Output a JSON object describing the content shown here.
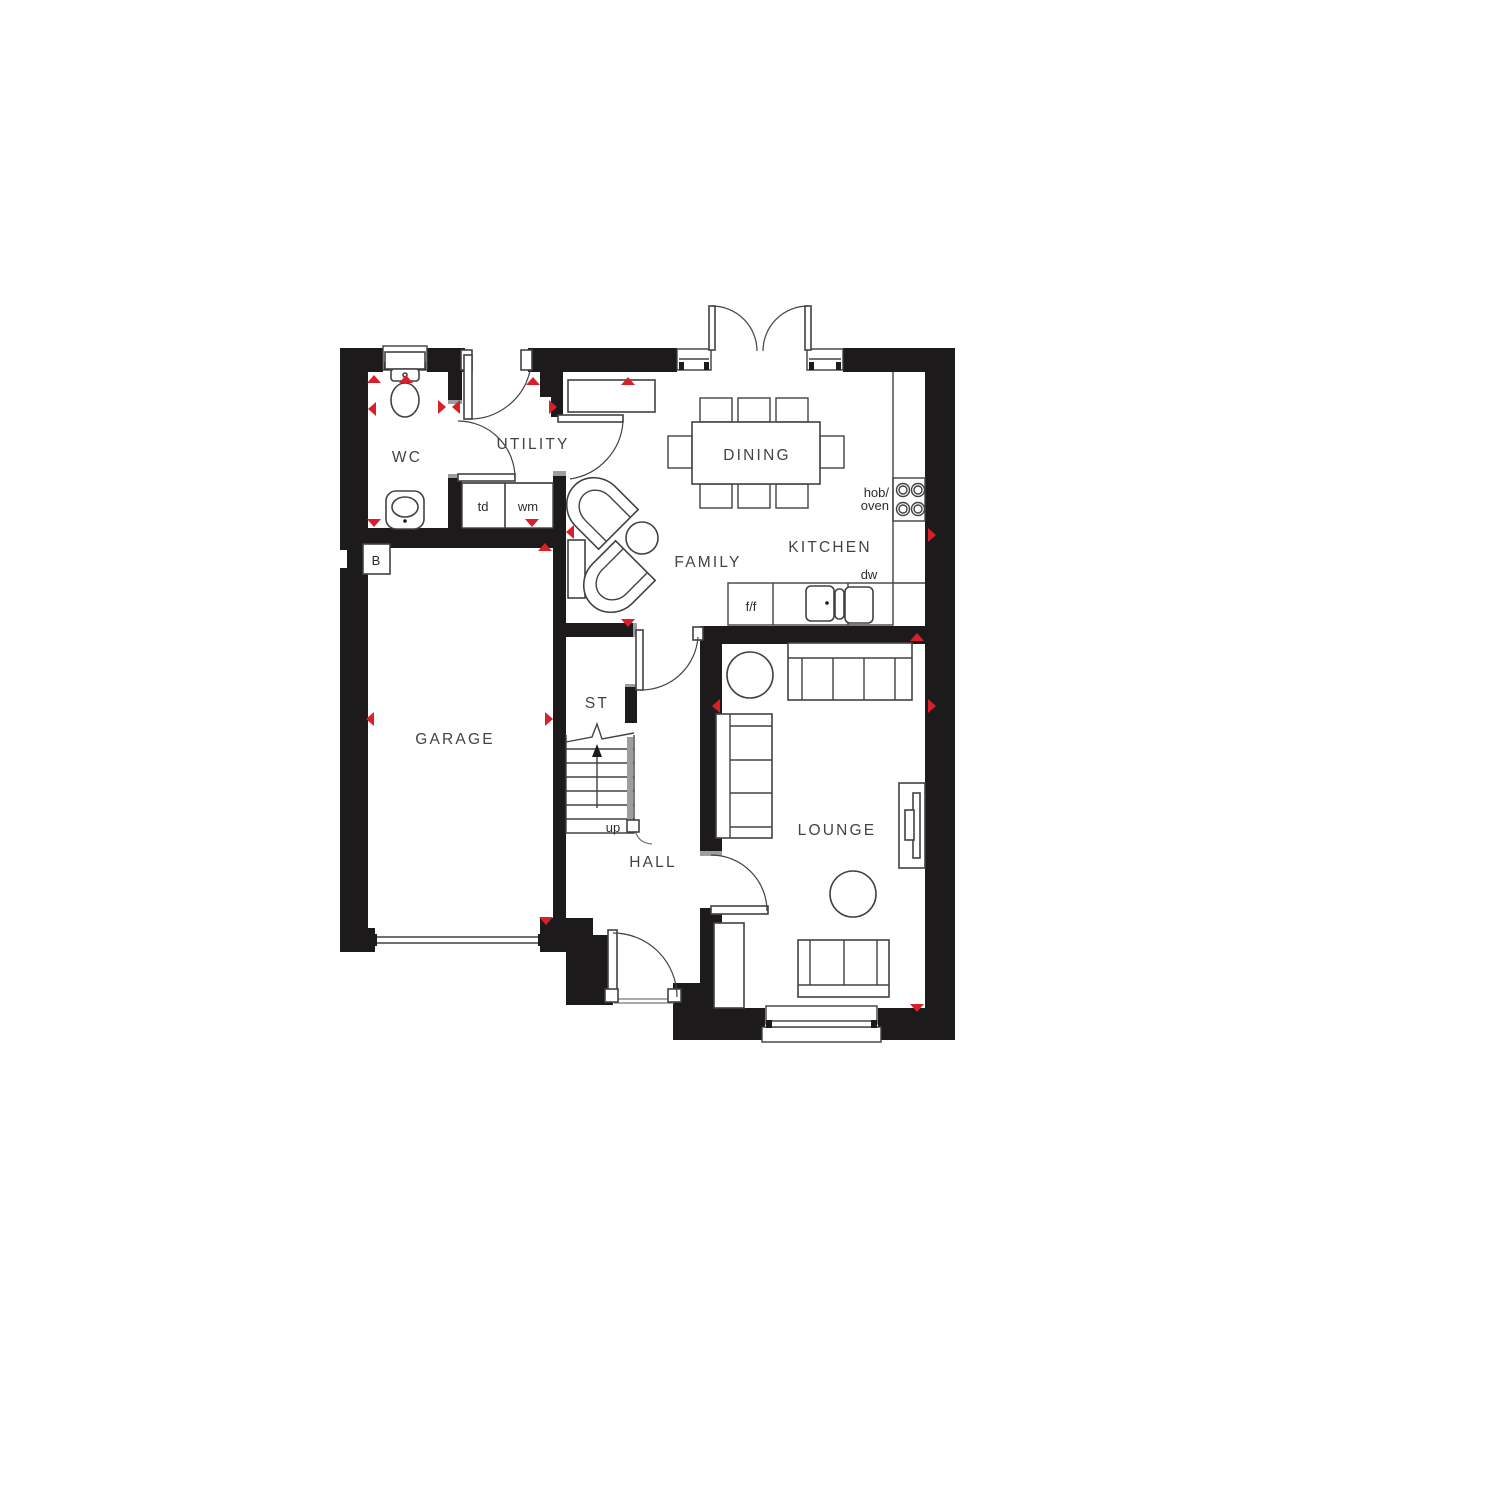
{
  "plan": {
    "rooms": {
      "wc": "WC",
      "utility": "UTILITY",
      "dining": "DINING",
      "kitchen": "KITCHEN",
      "family": "FAMILY",
      "garage": "GARAGE",
      "store": "ST",
      "hall": "HALL",
      "lounge": "LOUNGE"
    },
    "labels": {
      "tumble_dryer": "td",
      "washing_machine": "wm",
      "hob_oven_line1": "hob/",
      "hob_oven_line2": "oven",
      "dishwasher": "dw",
      "fridge_freezer": "f/f",
      "stairs_up": "up",
      "boiler": "B"
    },
    "colors": {
      "wall": "#1d1a1b",
      "marker": "#d6212a",
      "line": "#434143"
    }
  }
}
